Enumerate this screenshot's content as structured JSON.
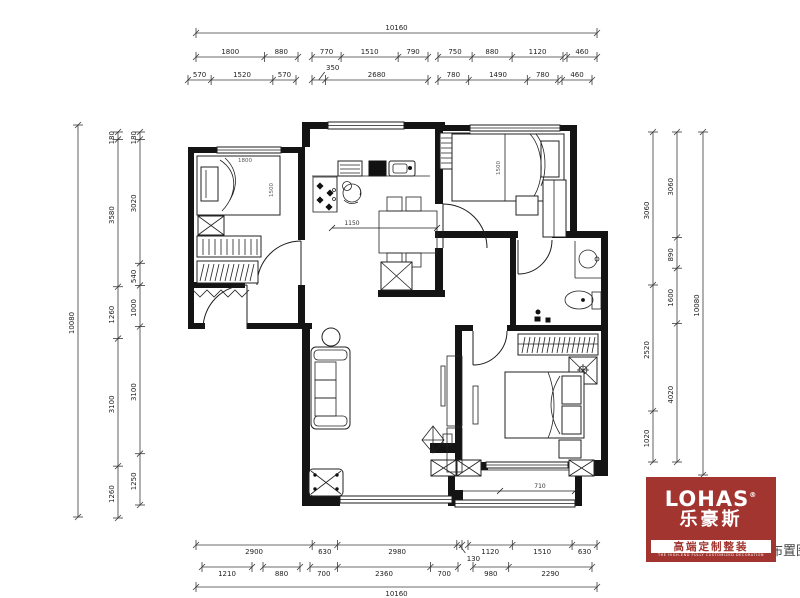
{
  "dims": {
    "top": {
      "total": [
        "10160"
      ],
      "row2a": [
        "1800",
        "880"
      ],
      "row2b": [
        "770",
        "1510",
        "790"
      ],
      "row2c": [
        "750",
        "880",
        "1120"
      ],
      "row2d": [
        "460"
      ],
      "row3a": [
        "570",
        "1520",
        "570"
      ],
      "row3b": [
        "350",
        "2680"
      ],
      "row3c": [
        "780",
        "1490",
        "780"
      ],
      "row3d": [
        "460"
      ]
    },
    "bottom": {
      "row1a": [
        "2900",
        "630",
        "2980",
        "130"
      ],
      "row1b": [
        "1120",
        "1510",
        "630"
      ],
      "row2a": [
        "1210"
      ],
      "row2b": [
        "880"
      ],
      "row2c": [
        "700",
        "2360",
        "700"
      ],
      "row2d": [
        "980",
        "2290"
      ],
      "total": [
        "10160"
      ]
    },
    "left": {
      "total": [
        "10080"
      ],
      "col2": [
        "180",
        "3580",
        "1260",
        "3100",
        "1260"
      ],
      "col3": [
        "180",
        "3020",
        "540",
        "1000",
        "3100",
        "1250"
      ]
    },
    "right": {
      "col1": [
        "3060",
        "2520",
        "1020"
      ],
      "col2": [
        "3060",
        "890",
        "1600",
        "4020"
      ],
      "total": [
        "10080"
      ]
    }
  },
  "plan_labels": {
    "dining": "1150",
    "bay": "710",
    "bed1_width": "1800",
    "bed1_length": "1500",
    "bed2_length": "1500"
  },
  "logo": {
    "brand": "LOHAS",
    "reg": "®",
    "brand_cn": "乐豪斯",
    "tagline": "高端定制整装",
    "subline": "THE HIGH-END FULLY CUSTOMIZED DECORATION",
    "red": "#a23530"
  },
  "stamp": {
    "text": "布置图"
  }
}
